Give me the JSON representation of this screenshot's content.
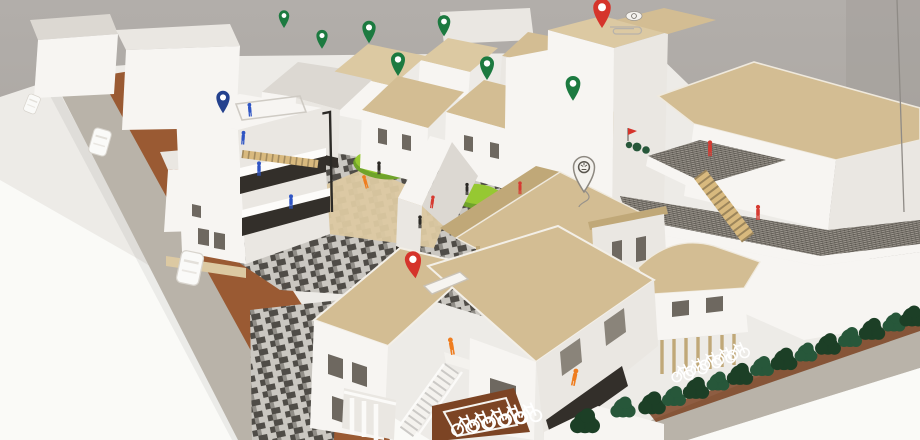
{
  "scene": {
    "type": "photograph",
    "subject": "Architectural scale model of an urban block photographed on a white table against a grey wall",
    "materials": "white foamboard buildings, kraft cardboard roofs, printed stone paving, model trees, map pins and scale figures"
  },
  "colors": {
    "wall": "#aba6a1",
    "wall_dark": "#a09b96",
    "table": "#edebe7",
    "table_bright": "#fafaf7",
    "road_brown": "#9a5a33",
    "road_brown_dark": "#7c4424",
    "sidewalk": "#b9b3a9",
    "paving_light": "#cac7c1",
    "paving_dark": "#4f4c47",
    "paving_mid": "#908d87",
    "grass": "#96c832",
    "grass_dark": "#6fa32a",
    "tree_dark": "#1c3f26",
    "tree_mid": "#27573a",
    "kraft": "#d3bd93",
    "kraft_light": "#dcc9a2",
    "kraft_dark": "#c0a878",
    "white_face": "#f7f5f2",
    "white_face_shade": "#eae7e2",
    "white_face_dark": "#dcd8d2",
    "balcony_dark": "#332f2a",
    "terrace": "#9c978e",
    "pin_green": "#1c7a40",
    "pin_red": "#d5342b",
    "pin_blue": "#24418e",
    "pin_white": "#f4f2ee",
    "figure_blue": "#2f55c4",
    "figure_red": "#d63a31",
    "figure_orange": "#ef7d1f",
    "figure_black": "#2c2a26",
    "stair_wood": "#d8b97e",
    "bike": "#ffffff",
    "window": "#6e6860"
  },
  "inventory": {
    "pins": {
      "green": 7,
      "red": 2,
      "blue": 1,
      "white_logo": 2
    },
    "figures": {
      "blue": 4,
      "red": 4,
      "orange": 3,
      "black": 3
    },
    "vehicles": {
      "white_foam_cars": 3,
      "wire_bicycles": 10
    },
    "greenery": {
      "hedge_trees": 13,
      "street_trees": 2,
      "grass_patches": 2,
      "terrace_shrubs": 3
    },
    "buildings": [
      {
        "name": "massing-blocks",
        "desc": "plain white foam slabs, back left"
      },
      {
        "name": "balcony-house",
        "desc": "three-storey white house with dark timber balconies, roof terrace and blue pin"
      },
      {
        "name": "gabled-house-cluster",
        "desc": "small white houses with kraft gable roofs marked by green pins"
      },
      {
        "name": "red-pin-tower",
        "desc": "tall white tower with flat kraft roof, red pin and paperclip"
      },
      {
        "name": "terraced-complex",
        "desc": "stepped white complex with grated terraces, cardboard stair and red figures"
      },
      {
        "name": "courtyard-pavilion",
        "desc": "large kraft gable roof on timber posts with white logo pin"
      },
      {
        "name": "flat-roof-house",
        "desc": "L-shaped house with flat kraft roof, rooflight, white external stair and red pin"
      },
      {
        "name": "arcade-house",
        "desc": "curved kraft roof over a timber colonnade with bicycle parking"
      }
    ],
    "streets": [
      {
        "name": "left-road",
        "desc": "brown paper road with white foam cars and grey kerb"
      },
      {
        "name": "central-plaza",
        "desc": "grey printed stone paving with grass patches, sand areas and a street lamp"
      },
      {
        "name": "right-promenade",
        "desc": "grey walk with dark hedge row and parked bicycles"
      }
    ]
  }
}
